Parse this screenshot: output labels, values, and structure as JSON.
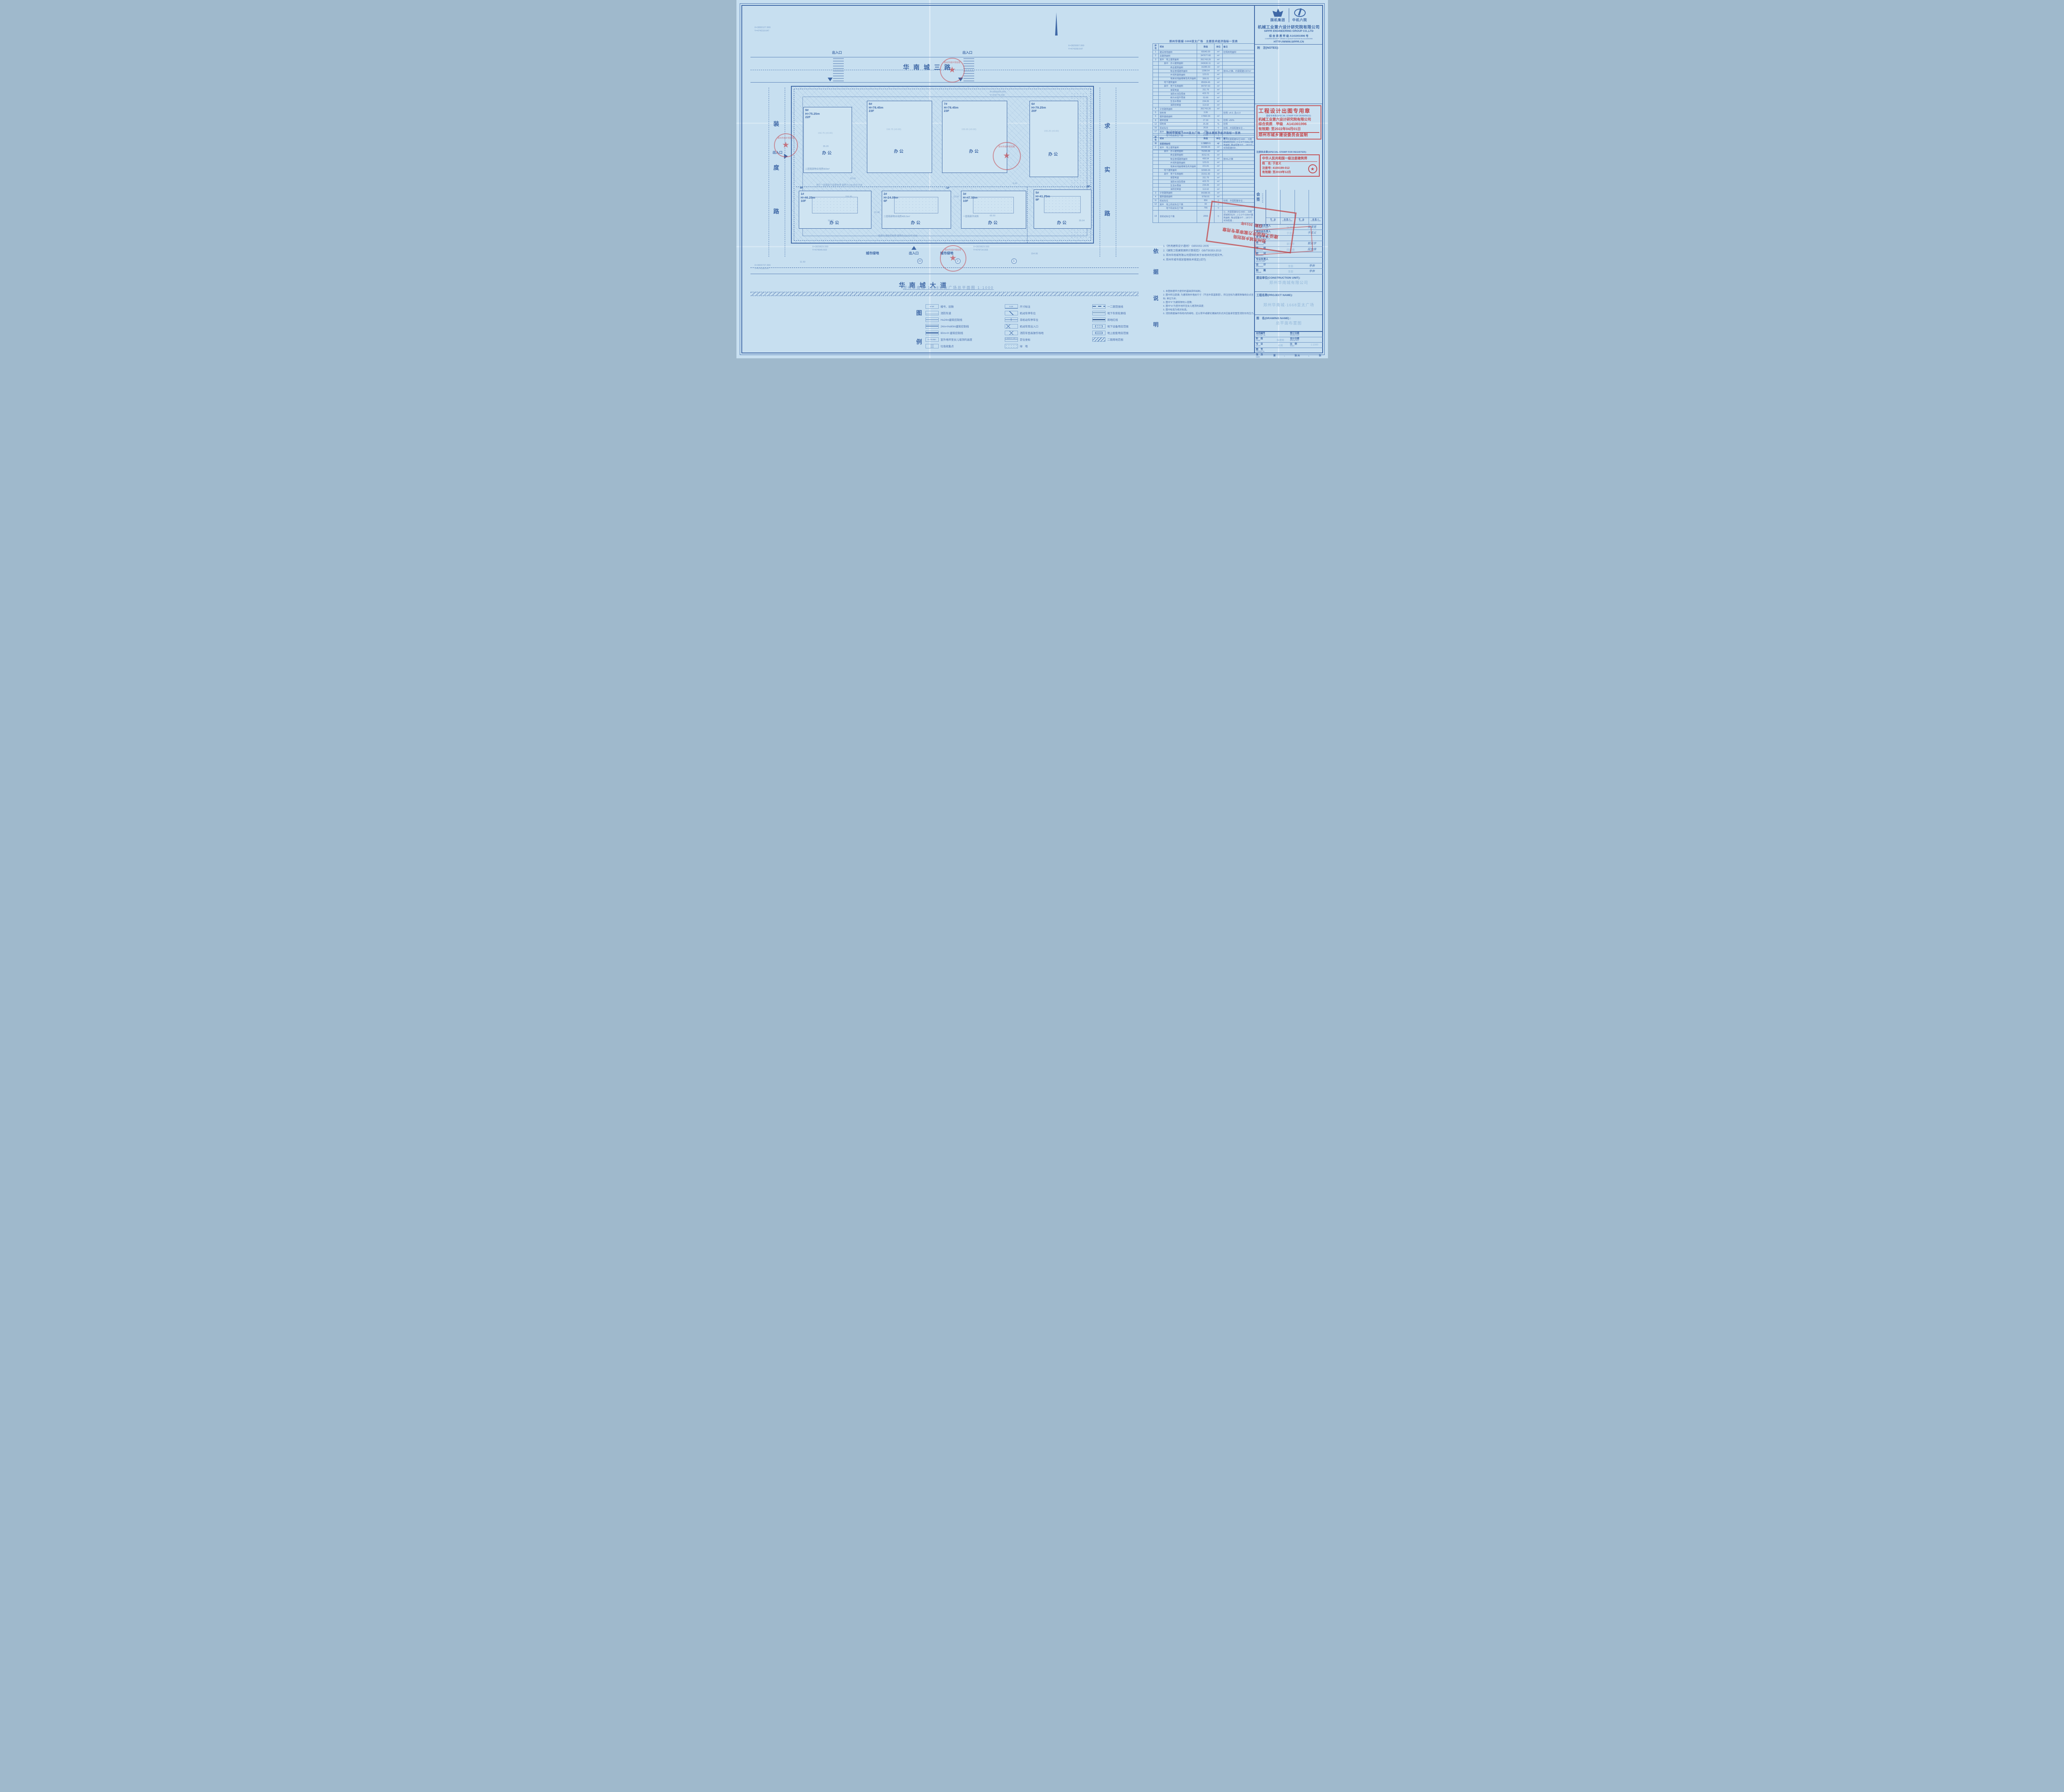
{
  "sheet": {
    "bg": "#c7dff0",
    "ink": "#3f68a6",
    "stamp_red": "#c23b3f"
  },
  "plan": {
    "roads": {
      "top": "华南城三路",
      "bottom": "华南城大道",
      "left": [
        "装",
        "度",
        "路"
      ],
      "right": [
        "求",
        "实",
        "路"
      ]
    },
    "entrance_label": "出入口",
    "green_label": "城市绿地",
    "caption": "郑州华南城·1668亚太广场总平面图 1:1000",
    "axis_bubbles": [
      "10",
      "2",
      "1"
    ],
    "float_note": "局部为消防控制室 面积为113.62平方米",
    "buildings_top": [
      {
        "no": "9#",
        "height": "H=75.25m",
        "floors": "22F",
        "use": "办公",
        "note": "二层局部物业用房903m²",
        "level": "156.75",
        "level2": "(±0.00)",
        "dim": "35.20"
      },
      {
        "no": "8#",
        "height": "H=78.45m",
        "floors": "23F",
        "use": "办公",
        "note": "",
        "level": "156.75",
        "level2": "(±0.00)",
        "dim": "60.20"
      },
      {
        "no": "7#",
        "height": "H=78.45m",
        "floors": "23F",
        "use": "办公",
        "note": "",
        "level": "155.65",
        "level2": "(±0.00)",
        "dim": "60.20"
      },
      {
        "no": "6#",
        "height": "H=79.25m",
        "floors": "20F",
        "use": "办公",
        "note": "",
        "level": "155.25",
        "level2": "(±0.00)",
        "dim": "60.20"
      }
    ],
    "buildings_bottom": [
      {
        "no": "1#",
        "height": "H=46.25m",
        "floors": "10F",
        "floors2": "9F",
        "use": "办公",
        "note": "地下一层局部为变配电室 面积为148.85平方米",
        "level": "156.95",
        "level2": "(±0.00)",
        "dim": "59.10"
      },
      {
        "no": "2#",
        "height": "H=24.05m",
        "floors": "6F",
        "floors2": "-1F",
        "use": "办公",
        "note": "二层局部物业用房495.5m²",
        "level": "156.20",
        "level2": "(±0.00)",
        "dim": "22.40"
      },
      {
        "no": "3#",
        "height": "H=47.50m",
        "floors": "10F",
        "floors2": "",
        "use": "办公",
        "note": "一层局部开闭所",
        "level": "155.65",
        "level2": "(±0.00)",
        "dim": "65.50"
      },
      {
        "no": "5#",
        "height": "H=41.75m",
        "floors": "9F",
        "floors2": "8F",
        "use": "办公",
        "note": "地下二层局部为消防水池及泵房 面积为423.70平方米",
        "level": "155.35",
        "level2": "(±0.00)",
        "dim": "59.10"
      }
    ],
    "coords": [
      {
        "x": "X=3830127.999",
        "y": "Y=474319.647"
      },
      {
        "x": "X=3829997.999",
        "y": "Y=474358.647"
      },
      {
        "x": "X=3829829.599",
        "y": "Y=474545.502"
      },
      {
        "x": "X=3829829.599",
        "y": "Y=474714.003"
      },
      {
        "x": "X=3829737.999",
        "y": "Y=474188.647"
      },
      {
        "x": "X=3829929.999",
        "y": "Y=474775.002"
      }
    ],
    "dims": [
      "21.50",
      "53.00",
      "6.00",
      "35.04",
      "154.95",
      "11.50"
    ]
  },
  "tables": {
    "headers": [
      "序号",
      "项目",
      "数值",
      "单位",
      "备注"
    ],
    "t1_title": "郑州华南城·1668亚太广场　主要技术经济指标一览表",
    "t1_rows": [
      {
        "no": "1",
        "label": "建设用地面积",
        "value": "65540.00",
        "unit": "m²",
        "remark": "控规用地面积"
      },
      {
        "no": "2",
        "label": "总建筑面积",
        "value": "347677.66",
        "unit": "m²",
        "remark": ""
      },
      {
        "no": "3",
        "label": "其中　地上建筑面积",
        "value": "261743.20",
        "unit": "m²",
        "remark": ""
      },
      {
        "no": "",
        "label": "　　其中　办公建筑面积",
        "value": "243630.11",
        "unit": "m²",
        "remark": ""
      },
      {
        "no": "",
        "label": "　　　　　商业建筑面积",
        "value": "16285.53",
        "unit": "m²",
        "remark": ""
      },
      {
        "no": "",
        "label": "　　　　　物业管理建筑面积",
        "value": "1398.54",
        "unit": "m²",
        "remark": "按4‰计算，约需配建1397m²"
      },
      {
        "no": "",
        "label": "　　　　　开闭所建筑面积",
        "value": "123.01",
        "unit": "m²",
        "remark": ""
      },
      {
        "no": "",
        "label": "　　　　　地库出地面楼梯及风井面积",
        "value": "306.01",
        "unit": "m²",
        "remark": ""
      },
      {
        "no": "",
        "label": "　　地下建筑面积",
        "value": "85934.46",
        "unit": "m²",
        "remark": ""
      },
      {
        "no": "",
        "label": "　　其中　地下车库面积",
        "value": "84797.63",
        "unit": "m²",
        "remark": ""
      },
      {
        "no": "",
        "label": "　　　　　变配电室",
        "value": "311.79",
        "unit": "m²",
        "remark": ""
      },
      {
        "no": "",
        "label": "　　　　　消防水池及泵房",
        "value": "423.70",
        "unit": "m²",
        "remark": ""
      },
      {
        "no": "",
        "label": "　　　　　雨污水提升泵房",
        "value": "53.66",
        "unit": "m²",
        "remark": ""
      },
      {
        "no": "",
        "label": "　　　　　生活水泵房",
        "value": "234.06",
        "unit": "m²",
        "remark": ""
      },
      {
        "no": "",
        "label": "　　　　　消防控制室",
        "value": "113.62",
        "unit": "m²",
        "remark": ""
      },
      {
        "no": "4",
        "label": "计容建筑面积",
        "value": "261743.20",
        "unit": "m²",
        "remark": ""
      },
      {
        "no": "5",
        "label": "容积率",
        "value": "3.99",
        "unit": "",
        "remark": "控规: ≤4.0, 且≥1.0"
      },
      {
        "no": "6",
        "label": "建筑基底面积",
        "value": "17892.03",
        "unit": "m²",
        "remark": ""
      },
      {
        "no": "8",
        "label": "建筑密度",
        "value": "27.30",
        "unit": "%",
        "remark": "控规: ≤50%"
      },
      {
        "no": "12",
        "label": "绿地率",
        "value": "25.08",
        "unit": "%",
        "remark": "控规"
      },
      {
        "no": "16",
        "label": "机动车位",
        "value": "2616",
        "unit": "个",
        "remark": "控规…共需配建车位…"
      },
      {
        "no": "17",
        "label": "其中　地上机动车位个数",
        "value": "190",
        "unit": "个",
        "remark": ""
      },
      {
        "no": "",
        "label": "　　　地下机动车位个数",
        "value": "2426",
        "unit": "个",
        "remark": ""
      },
      {
        "no": "18",
        "label": "非机动车位",
        "value": "5627",
        "unit": "个",
        "remark": "1)…共需配建车位1682… 2)按郑城规交[20…] 公:2个/100m²建筑面积, 物业配套:8个…1872个; 实际配建558…"
      }
    ],
    "t2_title": "郑州华南城·1668亚太广场　一期主要技术经济指标一览表",
    "t2_rows": [
      {
        "no": "1",
        "label": "总建筑面积",
        "value": "117283.65",
        "unit": "m²",
        "remark": ""
      },
      {
        "no": "2",
        "label": "其中　地上建筑面积",
        "value": "84288.65",
        "unit": "m²",
        "remark": ""
      },
      {
        "no": "",
        "label": "　　其中　办公建筑面积",
        "value": "76295.88",
        "unit": "m²",
        "remark": ""
      },
      {
        "no": "",
        "label": "　　　　　商业建筑面积",
        "value": "8152.41",
        "unit": "m²",
        "remark": ""
      },
      {
        "no": "",
        "label": "　　　　　物业管理建筑面积",
        "value": "495.54",
        "unit": "m²",
        "remark": "按4‰计算"
      },
      {
        "no": "",
        "label": "　　　　　开闭所建筑面积",
        "value": "123.01",
        "unit": "m²",
        "remark": ""
      },
      {
        "no": "",
        "label": "　　　　　地库出地面楼梯及风井面积",
        "value": "221.81",
        "unit": "m²",
        "remark": ""
      },
      {
        "no": "",
        "label": "　　地下建筑面积",
        "value": "32995.00",
        "unit": "m²",
        "remark": ""
      },
      {
        "no": "",
        "label": "　　其中　地下车库面积",
        "value": "31911.83",
        "unit": "m²",
        "remark": ""
      },
      {
        "no": "",
        "label": "　　　　　变配电室",
        "value": "311.79",
        "unit": "m²",
        "remark": ""
      },
      {
        "no": "",
        "label": "　　　　　消防水池及泵房",
        "value": "423.70",
        "unit": "m²",
        "remark": ""
      },
      {
        "no": "",
        "label": "　　　　　生活水泵房",
        "value": "234.06",
        "unit": "m²",
        "remark": ""
      },
      {
        "no": "",
        "label": "　　　　　消防控制室",
        "value": "113.62",
        "unit": "m²",
        "remark": ""
      },
      {
        "no": "3",
        "label": "计容建筑面积",
        "value": "84288.65",
        "unit": "m²",
        "remark": ""
      },
      {
        "no": "4",
        "label": "建筑基底面积",
        "value": "9758.91",
        "unit": "m²",
        "remark": ""
      },
      {
        "no": "11",
        "label": "机动车位",
        "value": "856",
        "unit": "个",
        "remark": "控规…共需配建车位…"
      },
      {
        "no": "12",
        "label": "其中　地上机动车位个数",
        "value": "90",
        "unit": "个",
        "remark": ""
      },
      {
        "no": "",
        "label": "　　　地下机动车位个数",
        "value": "766",
        "unit": "个",
        "remark": ""
      },
      {
        "no": "13",
        "label": "非机动车位个数",
        "value": "2053",
        "unit": "个",
        "remark": "1)…共需配建车位1682… 2)按郑城规交[20…] 公:2个/100m²建筑面积, 物业配套:8个…1872个; 实际配建…"
      }
    ]
  },
  "notes": {
    "basis_label": [
      "依",
      "据"
    ],
    "basis": [
      "1.《民用建筑设计通则》 GB50352-2005",
      "2.《建筑工程建筑面积计算规范》 GB/T50353-2013",
      "3. 郑州华南城有限公司提供的关于本地块的控规文件。",
      "4. 郑州市城市规划管理技术规定(试行)"
    ],
    "desc_label": [
      "说",
      "明"
    ],
    "desc": [
      "1. 本图依据甲方提供的基础资料绘制。",
      "2. 图中所注距离: 为建筑物外墙皮尺寸（不含外保温厚度），所注坐标为建筑物轴线交点坐标; 单位为米;",
      "3. 图中“F”为建筑物地上层数;",
      "4. 图中“H”为室外地坪至女儿墙顶的高度;",
      "5. 图中标高为绝对标高。",
      "6. 消防救援操作场地内的绿地，应以草坪或硬化铺装的形式并应能承受重型消防车的压力。"
    ]
  },
  "legend": {
    "label": [
      "图",
      "例"
    ],
    "col1": [
      {
        "sym": "bldg",
        "symtext": "1#  6F",
        "text": "楼号、层数"
      },
      {
        "sym": "firelane",
        "symtext": "",
        "text": "消防车道"
      },
      {
        "sym": "line24",
        "symtext": "",
        "text": "H≤24m建筑控制线"
      },
      {
        "sym": "line60",
        "symtext": "",
        "text": "24m<H≤60m建筑控制线"
      },
      {
        "sym": "line60p",
        "symtext": "",
        "text": "60m<H 建筑控制线"
      },
      {
        "sym": "height",
        "symtext": "H=79.95m",
        "text": "室外地坪至女儿墙顶的高度"
      },
      {
        "sym": "trash",
        "symtext": "",
        "text": "垃圾收集点"
      }
    ],
    "col2": [
      {
        "sym": "dim",
        "symtext": "9.19",
        "text": "尺寸标注"
      },
      {
        "sym": "parking",
        "symtext": "",
        "text": "机动车停车位"
      },
      {
        "sym": "bike",
        "symtext": "",
        "text": "非机动车停车位"
      },
      {
        "sym": "garage",
        "symtext": "",
        "text": "机动车库出入口"
      },
      {
        "sym": "fireop",
        "symtext": "",
        "text": "消防车登高操作场地"
      },
      {
        "sym": "coord",
        "symtext": "X=3830121.499 Y=474405.755",
        "text": "定位坐标"
      },
      {
        "sym": "green",
        "symtext": "",
        "text": "绿　地"
      }
    ],
    "col3": [
      {
        "sym": "phase",
        "symtext": "",
        "text": "一二期范围线"
      },
      {
        "sym": "garageline",
        "symtext": "",
        "text": "地下车库轮廓线"
      },
      {
        "sym": "redline",
        "symtext": "",
        "text": "用地红线"
      },
      {
        "sym": "under",
        "symtext": "",
        "text": "地下设备用房范围"
      },
      {
        "sym": "above",
        "symtext": "",
        "text": "地上配套用房范围"
      },
      {
        "sym": "phase2",
        "symtext": "",
        "text": "二期用地范围"
      }
    ]
  },
  "titleblock": {
    "logo1": "国机集团",
    "logo2": "中机六院",
    "firm_cn": "机械工业第六设计研究院有限公司",
    "firm_en": "SIPPR ENGINEERING GROUP CO.,LTD",
    "qual_cn": "综 合 资 质 甲 级 A141001996 号",
    "qual_en": "COMPREHENSIVE GRADE A QUALIFICATION No.A141001996",
    "url": "HTTP://WWW.SIPPR.CN",
    "notes_label": "附　注(NOTES):",
    "register_label": "注册执业章(SPECIAL STAMP FOR REGISTER):",
    "countersign": {
      "cn": "会 签",
      "en": "COUNTER",
      "major_cn": "专　业",
      "major_en": "MAJOR",
      "signer_cn": "会 签 人",
      "signer_en": "COUNTER SIGN"
    },
    "sig_rows": [
      {
        "cn": "技术总负责人",
        "en": "TECHNICAL CHIEF",
        "name": "张清宽",
        "sign": "张清宽"
      },
      {
        "cn": "项目总负责人",
        "en": "PROJECT CHIEF",
        "name": "于忠义",
        "sign": "于忠义"
      },
      {
        "cn": "项 目 主 管",
        "en": "PROJECT DIRECTOR",
        "name": "",
        "sign": ""
      },
      {
        "cn": "审　　定",
        "en": "APPROVED",
        "name": "郭克宇",
        "sign": "郭克宇"
      },
      {
        "cn": "审　　核",
        "en": "CHECKED",
        "name": "段金焕",
        "sign": "段金焕"
      },
      {
        "cn": "校　　对",
        "en": "REVIEWED",
        "name": "",
        "sign": ""
      },
      {
        "cn": "专业负责人",
        "en": "MAJOR CHIEF",
        "name": "",
        "sign": ""
      },
      {
        "cn": "设　　计",
        "en": "DESIGNED",
        "name": "李奔",
        "sign": "李奔"
      },
      {
        "cn": "制　　图",
        "en": "DRAWN",
        "name": "李奔",
        "sign": "李奔"
      }
    ],
    "unit_label": "建设单位(CONSTRUCTION UNIT):",
    "unit_value": "郑州华南城有限公司",
    "project_label": "工程名称(PROJECT NAME):",
    "project_value": "郑州华南城·1668亚太广场",
    "drawing_label": "图　名(DRAWING NAME) :",
    "drawing_value": "总平面布置图",
    "fields": {
      "contract_cn": "合同编号",
      "contract_en": "CONTRACT No.",
      "contract_val": "",
      "signing_cn": "签订日期",
      "signing_en": "SIGNING DATE",
      "signing_val": "",
      "phase_cn": "阶　段",
      "phase_en": "PHASE",
      "phase_val": "报建图",
      "ddate_cn": "设计日期",
      "ddate_en": "DESIGN DATE",
      "ddate_val": "",
      "major_cn": "专　业",
      "major_en": "MAJOR",
      "major_val": "总图",
      "scale_cn": "比　例",
      "scale_en": "SCALE",
      "scale_val": "1:1000",
      "dno_cn": "图　号",
      "dno_en": "DRAWING No.",
      "dno_val": "",
      "index_cn": "张　次",
      "index_en": "INDEX",
      "no_label": "第",
      "no_val": "1",
      "mid_label": "张 共",
      "total_val": "1",
      "end_label": "张"
    }
  },
  "stamps": {
    "drawing": {
      "title": "工程设计出图专用章",
      "sub": "图纸专用章(SPECIAL STAMP FOR DRAWINGS):",
      "l1": "机械工业第六设计研究院有限公司",
      "l2": "综合资质　甲级　A141001996",
      "l3": "有效期: 至2022年04月01日",
      "l4": "郑州市城乡建设委员会监制"
    },
    "register": {
      "title": "中华人民共和国一级注册建筑师",
      "name_label": "姓　名:",
      "name": "于忠义",
      "reg_label": "注册号:",
      "reg": "4100199-012",
      "valid_label": "有效期:",
      "valid": "至2019年12月"
    },
    "review": {
      "l1": "郑州市城乡规划局",
      "l2": "建设工程设计方案审查专用章",
      "l3": "日期: 2019年"
    },
    "circle_text": "郑州市城乡规划局"
  }
}
